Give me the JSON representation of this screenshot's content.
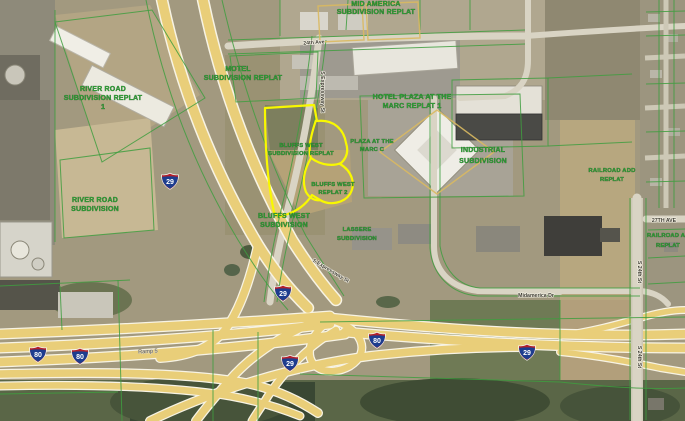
{
  "map": {
    "shields": {
      "i80": "80",
      "i29": "29"
    },
    "ramp_label": "Ramp 5",
    "roads": {
      "ave24": "24th Ave",
      "expressway": "S Expressway St",
      "midamerica": "Midamerica Dr",
      "ave27": "27TH AVE",
      "st24": "S 24th St"
    },
    "subdivisions": {
      "river_road_replat": {
        "l1": "RIVER ROAD",
        "l2": "SUBDIVISION REPLAT",
        "l3": "1"
      },
      "river_road": {
        "l1": "RIVER ROAD",
        "l2": "SUBDIVISION"
      },
      "motel": {
        "l1": "MOTEL",
        "l2": "SUBDIVISION REPLAT"
      },
      "top_replat": {
        "l1": "MID AMERICA",
        "l2": "SUBDIVISION REPLAT"
      },
      "hotel_plaza": {
        "l1": "HOTEL PLAZA AT THE",
        "l2": "MARC REPLAT 1"
      },
      "plaza_marc": {
        "l1": "PLAZA AT THE",
        "l2": "MARC C"
      },
      "bluffs_west_replat": {
        "l1": "BLUFFS WEST",
        "l2": "SUBDIVISION REPLAT"
      },
      "bluffs_west_2": {
        "l1": "BLUFFS WEST",
        "l2": "REPLAT 2"
      },
      "bluffs_west": {
        "l1": "BLUFFS WEST",
        "l2": "SUBDIVISION"
      },
      "lassere": {
        "l1": "LASSERE",
        "l2": "SUBDIVISION"
      },
      "industrial": {
        "l1": "INDUSTRIAL",
        "l2": "SUBDIVISION"
      },
      "railroad_w": {
        "l1": "RAILROAD ADD",
        "l2": "REPLAT"
      },
      "railroad_e": {
        "l1": "RAILROAD ADDITION",
        "l2": "REPLAT"
      }
    },
    "colors": {
      "parcel_line": "#3f9e3f",
      "highlight_yellow": "#f8f800",
      "label_green": "#2f9e35",
      "shield_blue": "#1d3d8f",
      "shield_red": "#b3202a",
      "road_yellow": "#e9ce79",
      "tan_outline": "#d9b961"
    }
  }
}
